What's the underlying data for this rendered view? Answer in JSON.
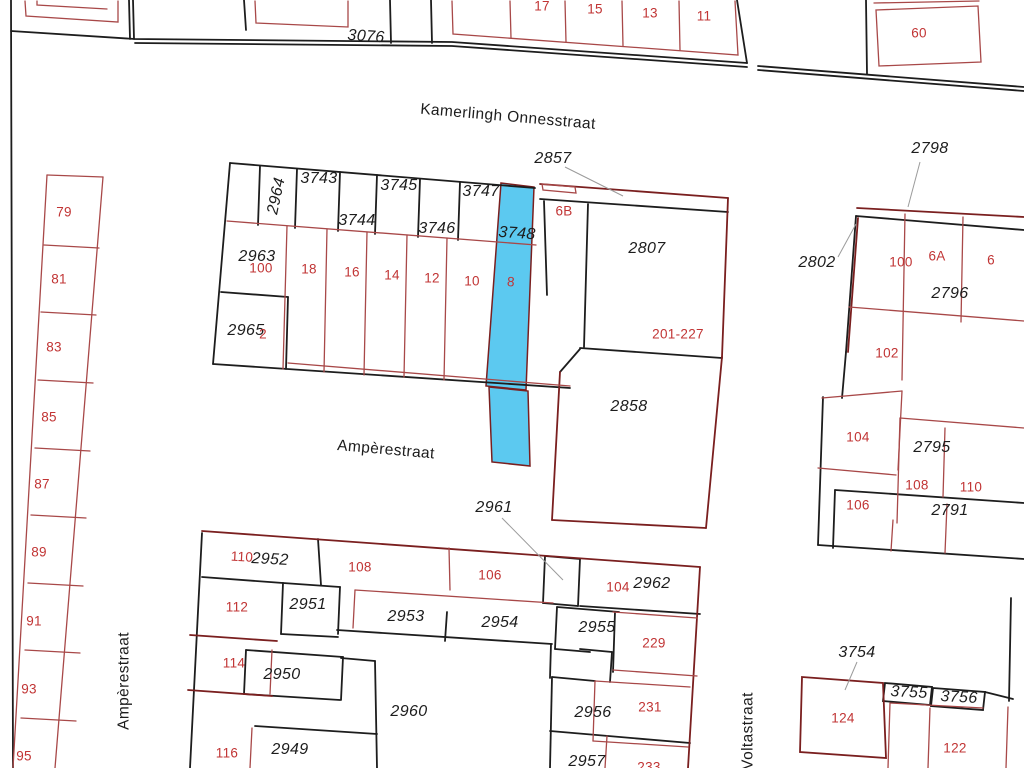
{
  "map_title": "kadastrale kaart",
  "colors": {
    "highlight_fill": "#5cc9f0",
    "boundary_black": "#1d1d1d",
    "boundary_dark_red": "#7a1f1f",
    "parcel_line_red": "#a84848",
    "house_number_red": "#c13434",
    "leader_gray": "#9b9b9b"
  },
  "street_labels": [
    {
      "text": "Kamerlingh Onnesstraat",
      "x": 508,
      "y": 117,
      "rot": 5
    },
    {
      "text": "Ampèrestraat",
      "x": 386,
      "y": 450,
      "rot": 5
    },
    {
      "text": "Ampèrestraat",
      "x": 124,
      "y": 681,
      "rot": -90
    },
    {
      "text": "Voltastraat",
      "x": 748,
      "y": 731,
      "rot": -90
    }
  ],
  "parcel_numbers": [
    {
      "text": "3076",
      "x": 366,
      "y": 37,
      "rot": 4
    },
    {
      "text": "2964",
      "x": 277,
      "y": 196,
      "rot": -78
    },
    {
      "text": "3743",
      "x": 319,
      "y": 179,
      "rot": 0
    },
    {
      "text": "3744",
      "x": 357,
      "y": 221,
      "rot": 0
    },
    {
      "text": "3745",
      "x": 399,
      "y": 186,
      "rot": 0
    },
    {
      "text": "3746",
      "x": 437,
      "y": 229,
      "rot": 0
    },
    {
      "text": "3747",
      "x": 481,
      "y": 192,
      "rot": 0
    },
    {
      "text": "3748",
      "x": 517,
      "y": 234,
      "rot": 4
    },
    {
      "text": "2857",
      "x": 553,
      "y": 159,
      "rot": 0
    },
    {
      "text": "2807",
      "x": 647,
      "y": 249,
      "rot": 0
    },
    {
      "text": "2963",
      "x": 257,
      "y": 257,
      "rot": 0
    },
    {
      "text": "2965",
      "x": 246,
      "y": 331,
      "rot": 0
    },
    {
      "text": "2858",
      "x": 629,
      "y": 407,
      "rot": 0
    },
    {
      "text": "2961",
      "x": 494,
      "y": 508,
      "rot": 0
    },
    {
      "text": "2798",
      "x": 930,
      "y": 149,
      "rot": 0
    },
    {
      "text": "2802",
      "x": 817,
      "y": 263,
      "rot": 0
    },
    {
      "text": "2796",
      "x": 950,
      "y": 294,
      "rot": 0
    },
    {
      "text": "2795",
      "x": 932,
      "y": 448,
      "rot": 0
    },
    {
      "text": "2791",
      "x": 950,
      "y": 511,
      "rot": 0
    },
    {
      "text": "2952",
      "x": 270,
      "y": 560,
      "rot": 3
    },
    {
      "text": "2951",
      "x": 308,
      "y": 605,
      "rot": 0
    },
    {
      "text": "2953",
      "x": 406,
      "y": 617,
      "rot": 0
    },
    {
      "text": "2954",
      "x": 500,
      "y": 623,
      "rot": 0
    },
    {
      "text": "2955",
      "x": 597,
      "y": 628,
      "rot": 0
    },
    {
      "text": "2962",
      "x": 652,
      "y": 584,
      "rot": 0
    },
    {
      "text": "2950",
      "x": 282,
      "y": 675,
      "rot": 0
    },
    {
      "text": "2960",
      "x": 409,
      "y": 712,
      "rot": 0
    },
    {
      "text": "2949",
      "x": 290,
      "y": 750,
      "rot": 0
    },
    {
      "text": "2956",
      "x": 593,
      "y": 713,
      "rot": 0
    },
    {
      "text": "2957",
      "x": 587,
      "y": 762,
      "rot": 0
    },
    {
      "text": "3754",
      "x": 857,
      "y": 653,
      "rot": 0
    },
    {
      "text": "3755",
      "x": 909,
      "y": 693,
      "rot": 3
    },
    {
      "text": "3756",
      "x": 959,
      "y": 698,
      "rot": 3
    }
  ],
  "house_numbers": [
    {
      "text": "17",
      "x": 542,
      "y": 6,
      "rot": 0
    },
    {
      "text": "15",
      "x": 595,
      "y": 9,
      "rot": 0
    },
    {
      "text": "13",
      "x": 650,
      "y": 13,
      "rot": 0
    },
    {
      "text": "11",
      "x": 704,
      "y": 16,
      "rot": 0
    },
    {
      "text": "60",
      "x": 919,
      "y": 33,
      "rot": 0
    },
    {
      "text": "79",
      "x": 64,
      "y": 212,
      "rot": 0
    },
    {
      "text": "81",
      "x": 59,
      "y": 279,
      "rot": 0
    },
    {
      "text": "83",
      "x": 54,
      "y": 347,
      "rot": 0
    },
    {
      "text": "85",
      "x": 49,
      "y": 417,
      "rot": 0
    },
    {
      "text": "87",
      "x": 42,
      "y": 484,
      "rot": 0
    },
    {
      "text": "89",
      "x": 39,
      "y": 552,
      "rot": 0
    },
    {
      "text": "91",
      "x": 34,
      "y": 621,
      "rot": 0
    },
    {
      "text": "93",
      "x": 29,
      "y": 689,
      "rot": 0
    },
    {
      "text": "95",
      "x": 24,
      "y": 756,
      "rot": 0
    },
    {
      "text": "100",
      "x": 261,
      "y": 268,
      "rot": 0
    },
    {
      "text": "18",
      "x": 309,
      "y": 269,
      "rot": 0
    },
    {
      "text": "16",
      "x": 352,
      "y": 272,
      "rot": 0
    },
    {
      "text": "14",
      "x": 392,
      "y": 275,
      "rot": 0
    },
    {
      "text": "12",
      "x": 432,
      "y": 278,
      "rot": 0
    },
    {
      "text": "10",
      "x": 472,
      "y": 281,
      "rot": 0
    },
    {
      "text": "8",
      "x": 511,
      "y": 282,
      "rot": 4
    },
    {
      "text": "2",
      "x": 263,
      "y": 334,
      "rot": 0
    },
    {
      "text": "6B",
      "x": 564,
      "y": 211,
      "rot": 0
    },
    {
      "text": "201-227",
      "x": 678,
      "y": 334,
      "rot": 0
    },
    {
      "text": "100",
      "x": 901,
      "y": 262,
      "rot": 0
    },
    {
      "text": "6A",
      "x": 937,
      "y": 256,
      "rot": 0
    },
    {
      "text": "6",
      "x": 991,
      "y": 260,
      "rot": 0
    },
    {
      "text": "102",
      "x": 887,
      "y": 353,
      "rot": 0
    },
    {
      "text": "104",
      "x": 858,
      "y": 437,
      "rot": 0
    },
    {
      "text": "108",
      "x": 917,
      "y": 485,
      "rot": 0
    },
    {
      "text": "110",
      "x": 971,
      "y": 487,
      "rot": 0
    },
    {
      "text": "106",
      "x": 858,
      "y": 505,
      "rot": 0
    },
    {
      "text": "110",
      "x": 242,
      "y": 557,
      "rot": 3
    },
    {
      "text": "108",
      "x": 360,
      "y": 567,
      "rot": 0
    },
    {
      "text": "106",
      "x": 490,
      "y": 575,
      "rot": 0
    },
    {
      "text": "104",
      "x": 618,
      "y": 587,
      "rot": 0
    },
    {
      "text": "112",
      "x": 237,
      "y": 607,
      "rot": 0
    },
    {
      "text": "114",
      "x": 234,
      "y": 663,
      "rot": 0
    },
    {
      "text": "116",
      "x": 227,
      "y": 753,
      "rot": 0
    },
    {
      "text": "229",
      "x": 654,
      "y": 643,
      "rot": 0
    },
    {
      "text": "231",
      "x": 650,
      "y": 707,
      "rot": 0
    },
    {
      "text": "233",
      "x": 649,
      "y": 767,
      "rot": 0
    },
    {
      "text": "124",
      "x": 843,
      "y": 718,
      "rot": 0
    },
    {
      "text": "122",
      "x": 955,
      "y": 748,
      "rot": 0
    }
  ]
}
